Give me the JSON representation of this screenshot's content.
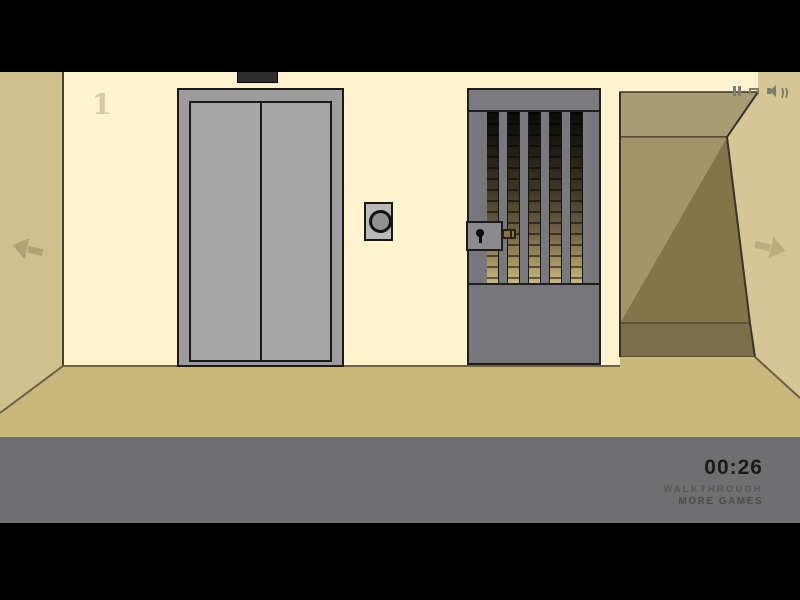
{
  "scene": {
    "floor_number": "1",
    "colors": {
      "letterbox": "#000000",
      "front_wall": "#fdf3ce",
      "left_wall": "#cfc08c",
      "right_wall": "#d6c695",
      "floor": "#c9b77b",
      "corridor_ceiling": "#a89c72",
      "corridor_back_wall_lit": "#a5946a",
      "corridor_back_wall_shadow": "#847448",
      "corridor_floor": "#7c6e49",
      "elevator_gray": "#a6a6a6",
      "gate_gray": "#76767b",
      "lock_bolt_brass": "#8a7340",
      "hud_bar": "#6f6f71",
      "timer_text": "#1a1a1a"
    }
  },
  "hud": {
    "timer": "00:26",
    "walkthrough_label": "WALKTHROUGH",
    "more_games_label": "MORE GAMES"
  },
  "icons": {
    "top_right": [
      "pause-icon",
      "quality-icon",
      "sound-icon"
    ],
    "navigation": [
      "left-arrow",
      "right-arrow"
    ],
    "gate": [
      "keyhole-icon"
    ]
  }
}
